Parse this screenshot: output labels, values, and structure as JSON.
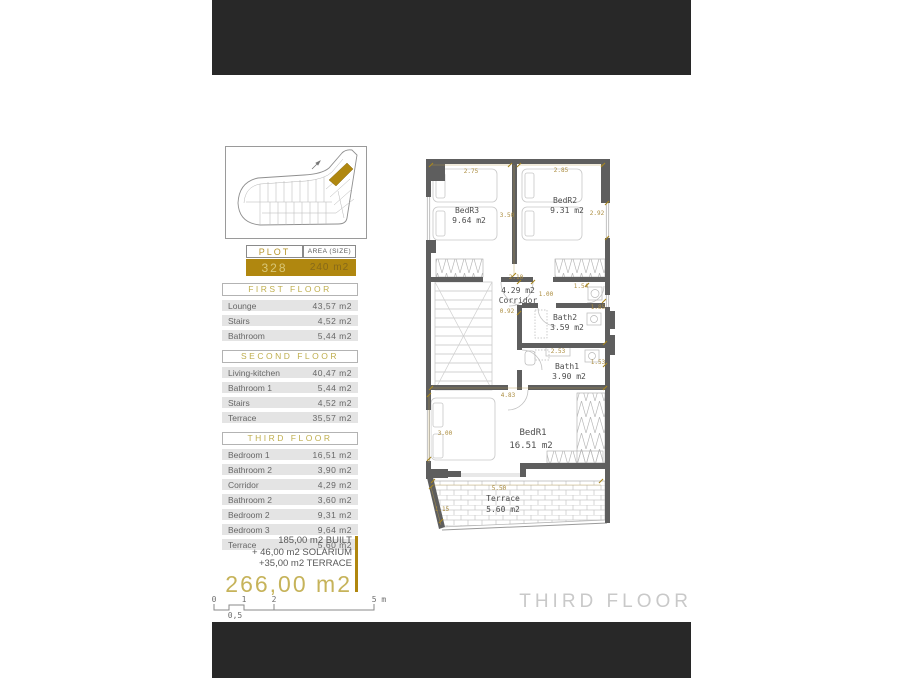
{
  "plot_table": {
    "header_plot": "PLOT",
    "header_area": "AREA (SIZE)",
    "value_plot": "328",
    "value_area": "240 m2"
  },
  "floors": [
    {
      "title": "FIRST FLOOR",
      "rows": [
        [
          "Lounge",
          "43,57 m2"
        ],
        [
          "Stairs",
          "4,52 m2"
        ],
        [
          "Bathroom",
          "5,44 m2"
        ]
      ]
    },
    {
      "title": "SECOND FLOOR",
      "rows": [
        [
          "Living-kitchen",
          "40,47 m2"
        ],
        [
          "Bathroom 1",
          "5,44 m2"
        ],
        [
          "Stairs",
          "4,52 m2"
        ],
        [
          "Terrace",
          "35,57 m2"
        ]
      ]
    },
    {
      "title": "THIRD FLOOR",
      "rows": [
        [
          "Bedroom 1",
          "16,51 m2"
        ],
        [
          "Bathroom 2",
          "3,90 m2"
        ],
        [
          "Corridor",
          "4,29 m2"
        ],
        [
          "Bathroom 2",
          "3,60 m2"
        ],
        [
          "Bedroom 2",
          "9,31 m2"
        ],
        [
          "Bedroom 3",
          "9,64 m2"
        ],
        [
          "Terrace",
          "5,60 m2"
        ]
      ]
    }
  ],
  "summary": {
    "line1": "185,00 m2 BUILT",
    "line2": "+ 46,00 m2 SOLARIUM",
    "line3": "+35,00 m2 TERRACE",
    "total": "266,00 m2"
  },
  "scale": {
    "t0": "0",
    "t1": "1",
    "t2": "2",
    "t5": "5 m",
    "half": "0,5"
  },
  "plan": {
    "floor_label": "THIRD FLOOR",
    "rooms": {
      "bedr3_name": "BedR3",
      "bedr3_area": "9.64 m2",
      "bedr2_name": "BedR2",
      "bedr2_area": "9.31 m2",
      "corridor_area": "4.29 m2",
      "corridor_name": "Corridor",
      "bath2_name": "Bath2",
      "bath2_area": "3.59 m2",
      "bath1_name": "Bath1",
      "bath1_area": "3.90 m2",
      "bedr1_name": "BedR1",
      "bedr1_area": "16.51 m2",
      "terrace_name": "Terrace",
      "terrace_area": "5.60 m2"
    },
    "dims": {
      "d275": "2.75",
      "d285": "2.85",
      "d350": "3.50",
      "d292": "2.92",
      "d210": "2.10",
      "d100": "1.00",
      "d154": "1.54",
      "d092": "0.92",
      "d185": "1.85",
      "d253": "2.53",
      "d153": "1.53",
      "d483": "4.83",
      "d300": "3.00",
      "d550": "5.50",
      "d115": "1.15"
    }
  },
  "colors": {
    "gold": "#b0870f",
    "gold_text": "#bfae4e",
    "dim_gold": "#ab8c3e",
    "wall_gray": "#5e5e5e",
    "banner": "#282828",
    "total_gold": "#c6b35a"
  }
}
